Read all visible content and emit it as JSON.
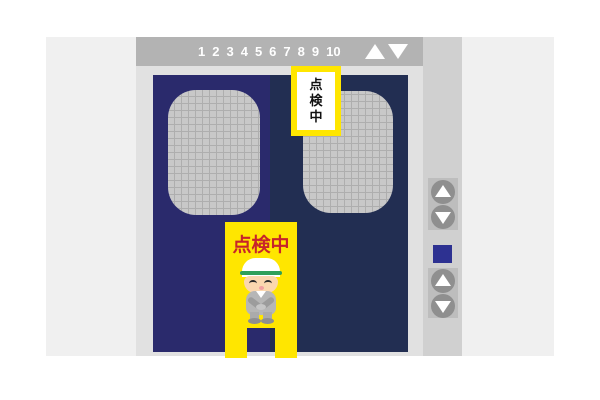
{
  "indicator": {
    "floors": [
      "1",
      "2",
      "3",
      "4",
      "5",
      "6",
      "7",
      "8",
      "9",
      "10"
    ],
    "up_icon": "up-triangle",
    "down_icon": "down-triangle"
  },
  "door_sign": {
    "text": "点検中",
    "chars": [
      "点",
      "検",
      "中"
    ]
  },
  "stand_sign": {
    "text": "点検中",
    "worker": "bowing-worker-with-cap"
  },
  "call_panel": {
    "groups": [
      {
        "buttons": [
          "up",
          "down"
        ]
      },
      {
        "buttons": [
          "up",
          "down"
        ]
      }
    ],
    "lamp": "blue-square-lamp"
  },
  "colors": {
    "left_door": "#2A2A6C",
    "right_door": "#222E52",
    "indicator_bar": "#B3B3B3",
    "frame": "#E1E1E1",
    "panel": "#D0D0D0",
    "sign_yellow": "#FFE600",
    "sign_red": "#C7242A",
    "call_button_blue": "#2D3191"
  }
}
